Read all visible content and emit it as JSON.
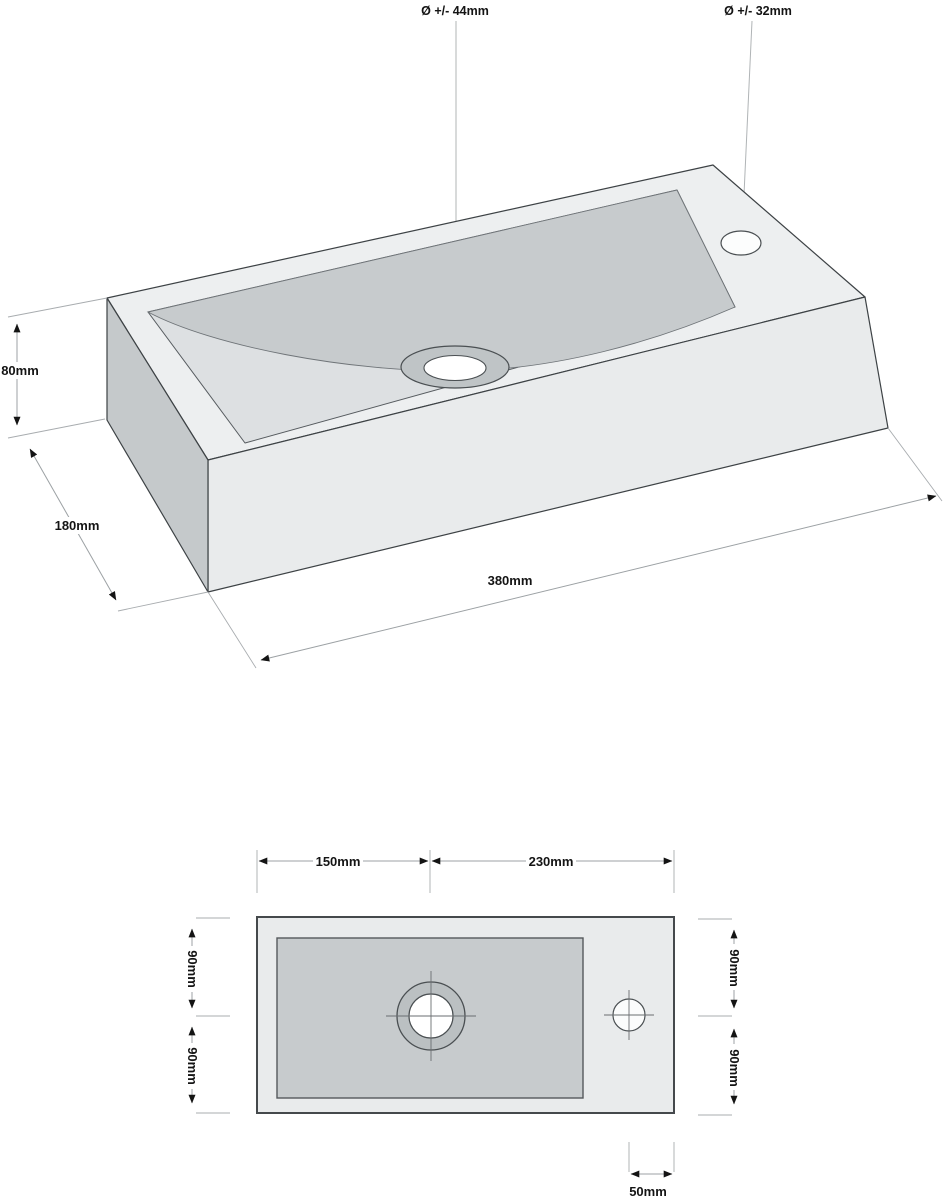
{
  "iso_view": {
    "drain_diameter_label": "Ø +/- 44mm",
    "tap_diameter_label": "Ø +/- 32mm",
    "height_label": "80mm",
    "depth_label": "180mm",
    "width_label": "380mm"
  },
  "plan_view": {
    "width_left_label": "150mm",
    "width_right_label": "230mm",
    "depth_left_top_label": "90mm",
    "depth_left_bottom_label": "90mm",
    "depth_right_top_label": "90mm",
    "depth_right_bottom_label": "90mm",
    "tap_offset_label": "50mm"
  },
  "colors": {
    "background": "#ffffff",
    "top_face": "#edeff0",
    "front_face": "#e9ebec",
    "side_face": "#c5c9cb",
    "basin_slope": "#c7cbcd",
    "basin_floor": "#dde0e2",
    "plan_body": "#e9ebec",
    "plan_basin": "#c7cbcd",
    "edge_line": "#3d4245",
    "dimension_line": "#9ca1a4",
    "text": "#141414"
  }
}
